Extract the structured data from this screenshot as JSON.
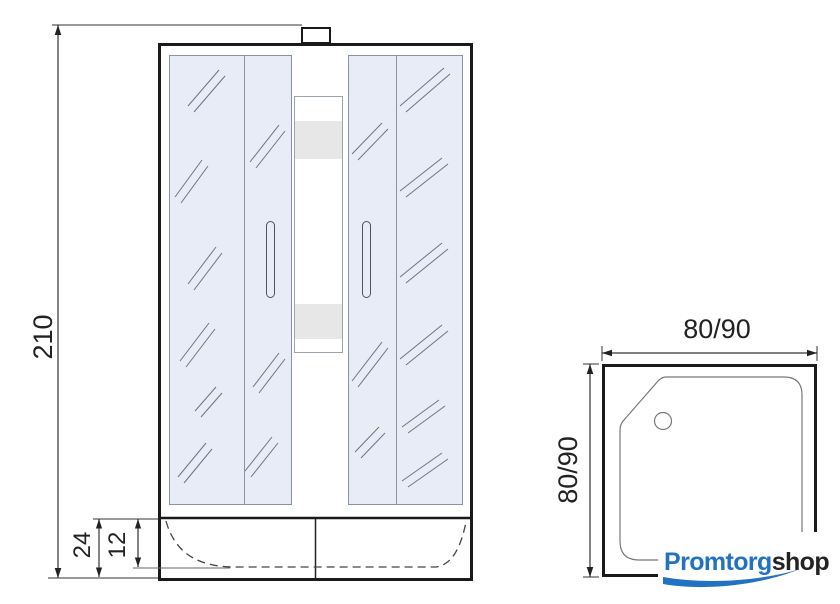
{
  "diagram": {
    "front_view": {
      "height": "210",
      "tray_height": "24",
      "tray_inner_depth": "12"
    },
    "top_view": {
      "width": "80/90",
      "depth": "80/90"
    }
  },
  "branding": {
    "primary": "Promtorg",
    "secondary": "shop"
  },
  "colors": {
    "outline": "#1a1a1a",
    "dimension_line": "#333333",
    "glass_fill": "#e8ecf6",
    "glass_line": "#8a93a5",
    "reflection_line": "#6a7487",
    "column_band": "#e7e7e7",
    "inner_line": "#777777",
    "logo_blue": "#2272c3",
    "logo_dark": "#232323"
  }
}
